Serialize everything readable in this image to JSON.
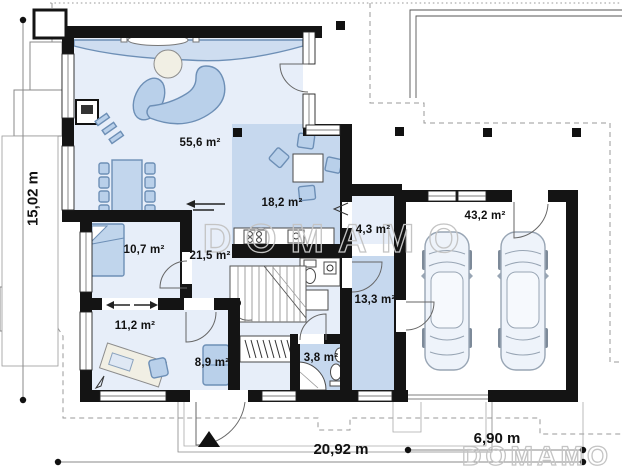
{
  "plan": {
    "type": "house-first-floor-plan",
    "watermark": "DOMAMO",
    "entrance_marker_icon": "triangle-up",
    "rooms": [
      {
        "id": "living-room",
        "area_label": "55,6 m²"
      },
      {
        "id": "kitchen",
        "area_label": "18,2 m²"
      },
      {
        "id": "pantry",
        "area_label": "4,3 m²"
      },
      {
        "id": "garage",
        "area_label": "43,2 m²"
      },
      {
        "id": "bedroom",
        "area_label": "10,7 m²"
      },
      {
        "id": "hall-stairs",
        "area_label": "21,5 m²"
      },
      {
        "id": "office",
        "area_label": "11,2 m²"
      },
      {
        "id": "vestibule",
        "area_label": "8,9 m²"
      },
      {
        "id": "bathroom",
        "area_label": "3,8 m²"
      },
      {
        "id": "utility-room",
        "area_label": "13,3 m²"
      }
    ],
    "dimensions": {
      "left": "15,02 m",
      "bottom": "20,92 m",
      "bottom_right": "6,90 m"
    },
    "palette": {
      "wall": "#141414",
      "room_light": "#e7eef9",
      "room_medium": "#c6d8ee",
      "furniture_fill": "#b9d0ea",
      "furniture_stroke": "#6d8fb6",
      "neutral_fill": "#f1efe4",
      "watermark": "#c4c4c4",
      "text": "#111111"
    }
  }
}
